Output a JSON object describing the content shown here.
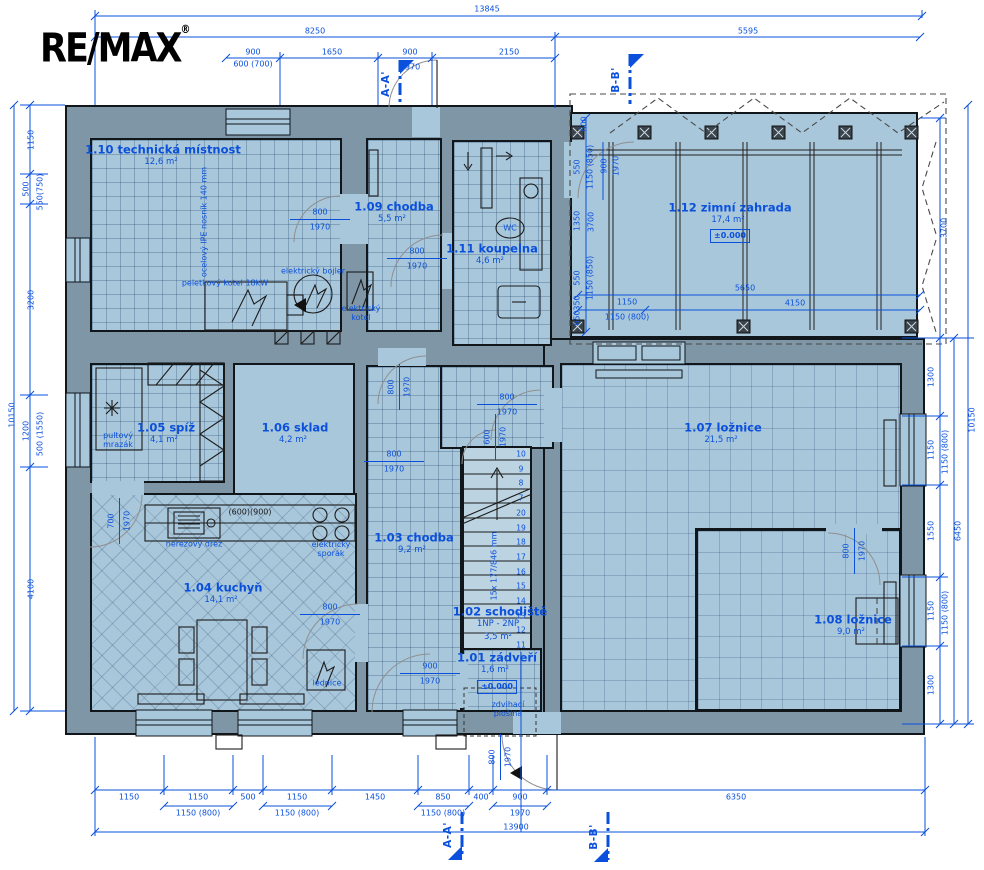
{
  "logo": {
    "text": "RE/MAX",
    "registered": "®"
  },
  "colors": {
    "accent_blue": "#0a50dc",
    "wall_fill": "#7e96a6",
    "floor_fill": "#a9c7db",
    "line_black": "#10161a"
  },
  "rooms": [
    {
      "name": "1.10 technická místnost",
      "area": "12,6 m²"
    },
    {
      "name": "1.09 chodba",
      "area": "5,5 m²"
    },
    {
      "name": "1.11 koupelna",
      "area": "4,6 m²"
    },
    {
      "name": "1.12 zimní zahrada",
      "area": "17,4 m²",
      "level": "±0.000"
    },
    {
      "name": "1.05 spíž",
      "area": "4,1 m²"
    },
    {
      "name": "1.06 sklad",
      "area": "4,2 m²"
    },
    {
      "name": "1.07 ložnice",
      "area": "21,5 m²"
    },
    {
      "name": "1.03 chodba",
      "area": "9,2 m²"
    },
    {
      "name": "1.04 kuchyň",
      "area": "14,1 m²"
    },
    {
      "name": "1.02 schodiště",
      "floors": "1NP - 2NP",
      "area": "3,5 m²"
    },
    {
      "name": "1.01 zádveří",
      "area": "1,6 m²",
      "level": "±0.000"
    },
    {
      "name": "1.08 ložnice",
      "area": "9,0 m²"
    }
  ],
  "equipment": [
    "ocelový IPE nosník 140 mm",
    "peletkový kotel 18kW",
    "elektrický bojler",
    "elektrický kotel",
    "WC",
    "nerezový dřez",
    "elektrický sporák",
    "lednice",
    "pultový mrazák",
    "(600)(900)",
    "zdvihací plošina"
  ],
  "stairs": {
    "spec": "15x 177/846 mm",
    "steps": [
      "10",
      "9",
      "8",
      "7",
      "20",
      "19",
      "18",
      "17",
      "16",
      "15",
      "14",
      "13",
      "12",
      "11"
    ]
  },
  "sections": {
    "a": "A-A'",
    "b": "B-B'"
  },
  "dims": {
    "top": [
      "13845",
      "8250",
      "5595",
      "900",
      "1650",
      "900",
      "2150",
      "600 (700)",
      "1970"
    ],
    "left": [
      "1150",
      "500",
      "550(750)",
      "3200",
      "1200",
      "500 (1550)",
      "4100",
      "10150"
    ],
    "right": [
      "3700",
      "1300",
      "1150",
      "1150 (800)",
      "1550",
      "1150",
      "1150 (800)",
      "1300",
      "6450",
      "10150"
    ],
    "bottom": [
      "1150",
      "1150",
      "500",
      "1150",
      "1450",
      "850",
      "400",
      "900",
      "6350",
      "1150 (800)",
      "1150 (800)",
      "1150 (800)",
      "1970",
      "13900"
    ],
    "winter_garden": [
      "600",
      "550",
      "1150 (850)",
      "900",
      "1970",
      "1350",
      "3700",
      "550",
      "1150 (850)",
      "350",
      "650",
      "1150",
      "1150 (800)",
      "5650",
      "4150"
    ],
    "doors": [
      {
        "w": "800",
        "h": "1970"
      },
      {
        "w": "800",
        "h": "1970"
      },
      {
        "w": "700",
        "h": "1970"
      },
      {
        "w": "800",
        "h": "1970"
      },
      {
        "w": "800",
        "h": "1970"
      },
      {
        "w": "600",
        "h": "1970"
      },
      {
        "w": "800",
        "h": "1970"
      },
      {
        "w": "800",
        "h": "1970"
      },
      {
        "w": "900",
        "h": "1970"
      },
      {
        "w": "800",
        "h": "1970"
      },
      {
        "w": "800",
        "h": "1970"
      }
    ]
  }
}
